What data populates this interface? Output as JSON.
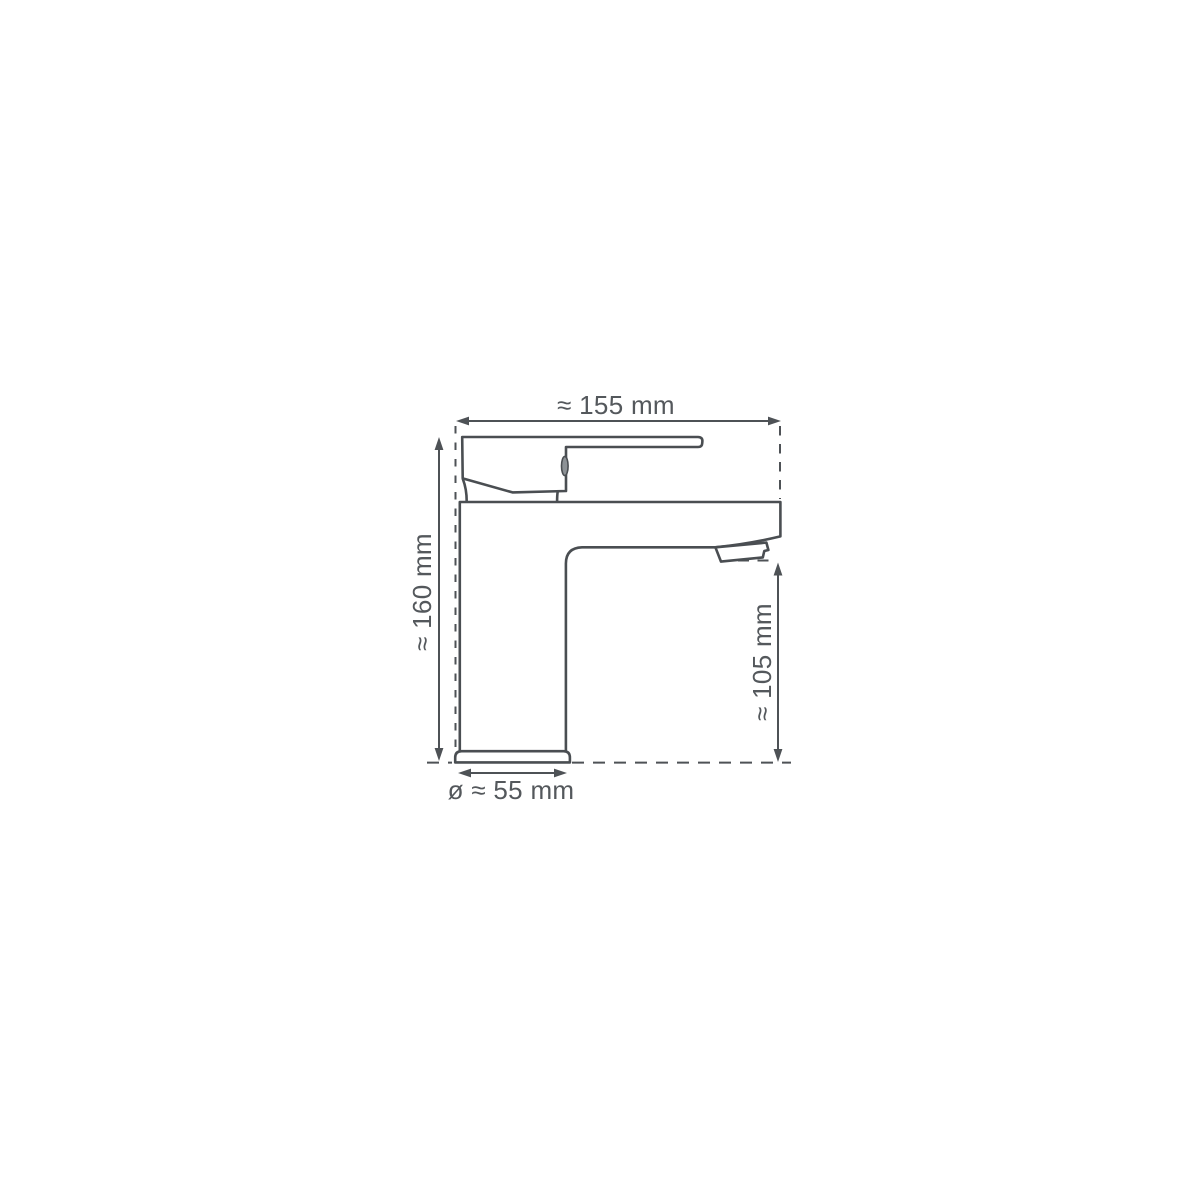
{
  "diagram": {
    "type": "technical-drawing",
    "subject": "single-lever basin mixer tap, side view with dimension lines",
    "labels": {
      "total_width": "≈ 155 mm",
      "total_height": "≈ 160 mm",
      "spout_height": "≈ 105 mm",
      "base_diameter": "ø ≈ 55 mm"
    },
    "values": {
      "total_width_mm": 155,
      "total_height_mm": 160,
      "spout_height_mm": 105,
      "base_diameter_mm": 55
    },
    "colors": {
      "background": "#ffffff",
      "line": "#4a4e52",
      "dimension_line": "#4e5256",
      "text": "#54585c"
    }
  }
}
